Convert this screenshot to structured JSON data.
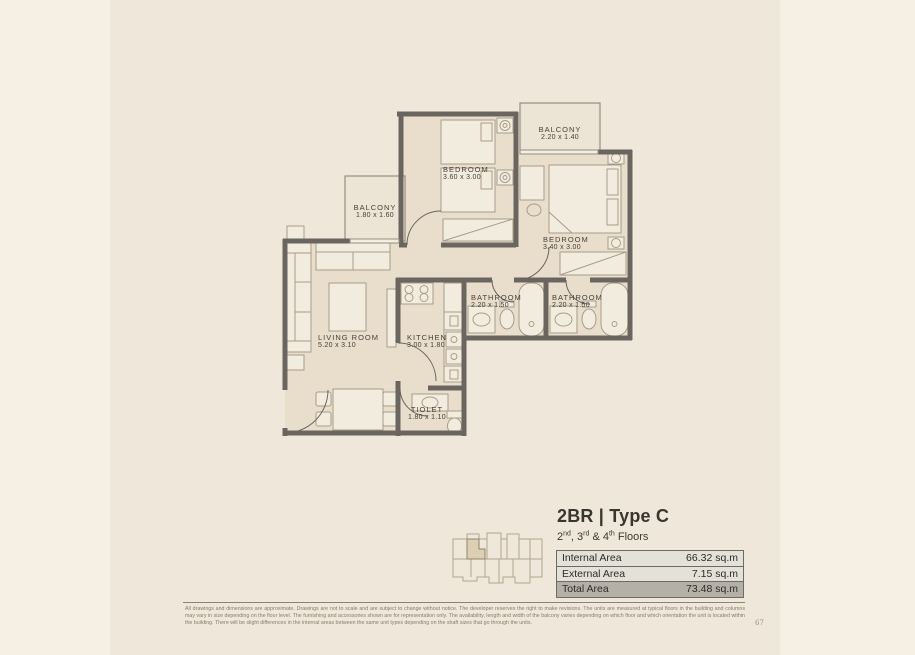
{
  "plan": {
    "rooms": [
      {
        "name": "BEDROOM",
        "dims": "3.60 x 3.00"
      },
      {
        "name": "BALCONY",
        "dims": "2.20 x 1.40"
      },
      {
        "name": "BEDROOM",
        "dims": "3.40 x 3.00"
      },
      {
        "name": "BALCONY",
        "dims": "1.80 x 1.60"
      },
      {
        "name": "LIVING ROOM",
        "dims": "5.20 x 3.10"
      },
      {
        "name": "KITCHEN",
        "dims": "3.00 x 1.80"
      },
      {
        "name": "BATHROOM",
        "dims": "2.20 x 1.50"
      },
      {
        "name": "BATHROOM",
        "dims": "2.20 x 1.50"
      },
      {
        "name": "TIOLET",
        "dims": "1.80 x 1.10"
      }
    ]
  },
  "info": {
    "title": "2BR | Type C",
    "subtitle": {
      "p1": "2",
      "s1": "nd",
      "p2": ", 3",
      "s2": "rd",
      "p3": " & 4",
      "s3": "th",
      "p4": " Floors"
    },
    "table": {
      "rows": [
        {
          "label": "Internal Area",
          "value": "66.32 sq.m",
          "highlight": false
        },
        {
          "label": "External Area",
          "value": "7.15 sq.m",
          "highlight": false
        },
        {
          "label": "Total Area",
          "value": "73.48 sq.m",
          "highlight": true
        }
      ]
    }
  },
  "footer": {
    "disclaimer": "All drawings and dimensions are approximate. Drawings are not to scale and are subject to change without notice. The developer reserves the right to make revisions. The units are measured at typical floors in the building and columns may vary in size depending on the floor level. The furnishing and accessories shown are for representation only. The availability, length and width of the balcony varies depending on which floor and which orientation the unit is located within the building. There will be slight differences in the internal areas between the same unit types depending on the shaft sizes that go through the units.",
    "page_number": "67"
  },
  "colors": {
    "page_background": "#f6f0e4",
    "inner_band": "#efe8da",
    "room_floor": "#e8decb",
    "balcony_floor": "#ece4d4",
    "wall": "#6b6560",
    "furniture_line": "#a89c88",
    "total_row_background": "#b4b0a7",
    "table_row_background": "#e4e1d9"
  }
}
